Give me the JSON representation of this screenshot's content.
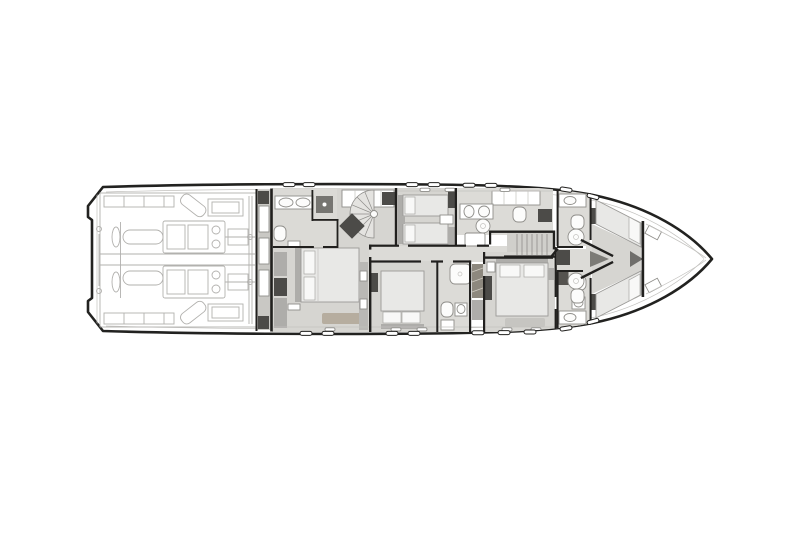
{
  "figure": {
    "kind": "yacht-lower-deck-floor-plan",
    "orientation": "bow-right"
  },
  "regions": [
    "hull-outline",
    "transom-swim-deck",
    "engine-room",
    "technical-compartment",
    "master-suite",
    "master-bathroom",
    "spiral-staircase",
    "twin-guest-cabin",
    "central-corridor",
    "guest-cabin",
    "guest-bathroom",
    "galley-laundry",
    "companionway-stairs",
    "vip-cabin",
    "vip-bathroom",
    "forward-bathroom-upper",
    "forward-bathroom-lower",
    "v-berth-crew-cabin",
    "forward-bulkhead",
    "bow-compartment"
  ],
  "colors": {
    "bg": "#ffffff",
    "hull": "#222220",
    "wall": "#21201e",
    "floor": "#d6d5d1",
    "floor-light": "#dcdbd7",
    "tread-floor": "#d0cfcb",
    "bed": "#e8e8e6",
    "pillow": "#f8f8f7",
    "mid": "#aeadaa",
    "dark": "#4c4b48",
    "tan": "#b6ad9f",
    "band": "#c9c8c4",
    "engine": "#b2b1ae",
    "fixture": "#8f8e8a",
    "thin": "#c3c2bf"
  }
}
